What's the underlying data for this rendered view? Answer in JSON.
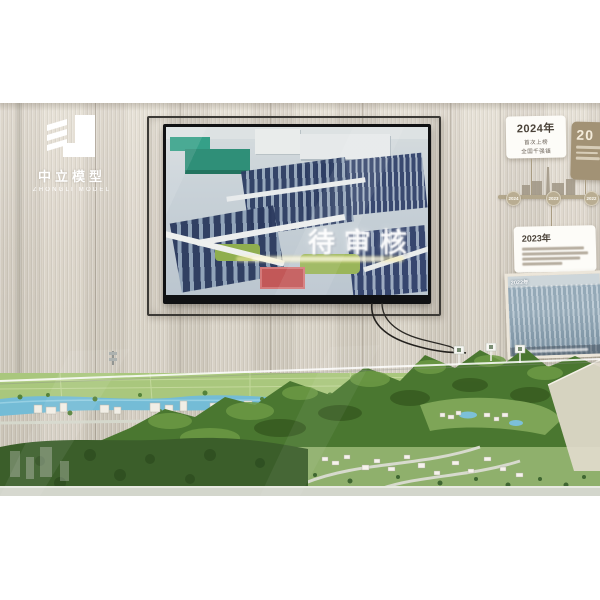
{
  "logo": {
    "name_cn": "中立模型",
    "name_en": "ZHONGLI MODEL"
  },
  "tv_video": {
    "title_overlay": "待审核"
  },
  "timeline": {
    "card_2024": {
      "year": "2024年",
      "line1": "首次上榜",
      "line2": "全国千强镇"
    },
    "card_partial": {
      "label": "20"
    },
    "card_2023": {
      "year": "2023年"
    },
    "photo_2022": {
      "label": "2022年"
    },
    "nodes": [
      {
        "year": "2024"
      },
      {
        "year": "2023"
      },
      {
        "year": "2022"
      }
    ]
  },
  "colors": {
    "wall": "#d6cfc3",
    "timeline_tan": "#b3a78c",
    "model_green": "#4a7730",
    "river_blue": "#74bcd6",
    "solar_panel_navy": "#2e3e63"
  }
}
